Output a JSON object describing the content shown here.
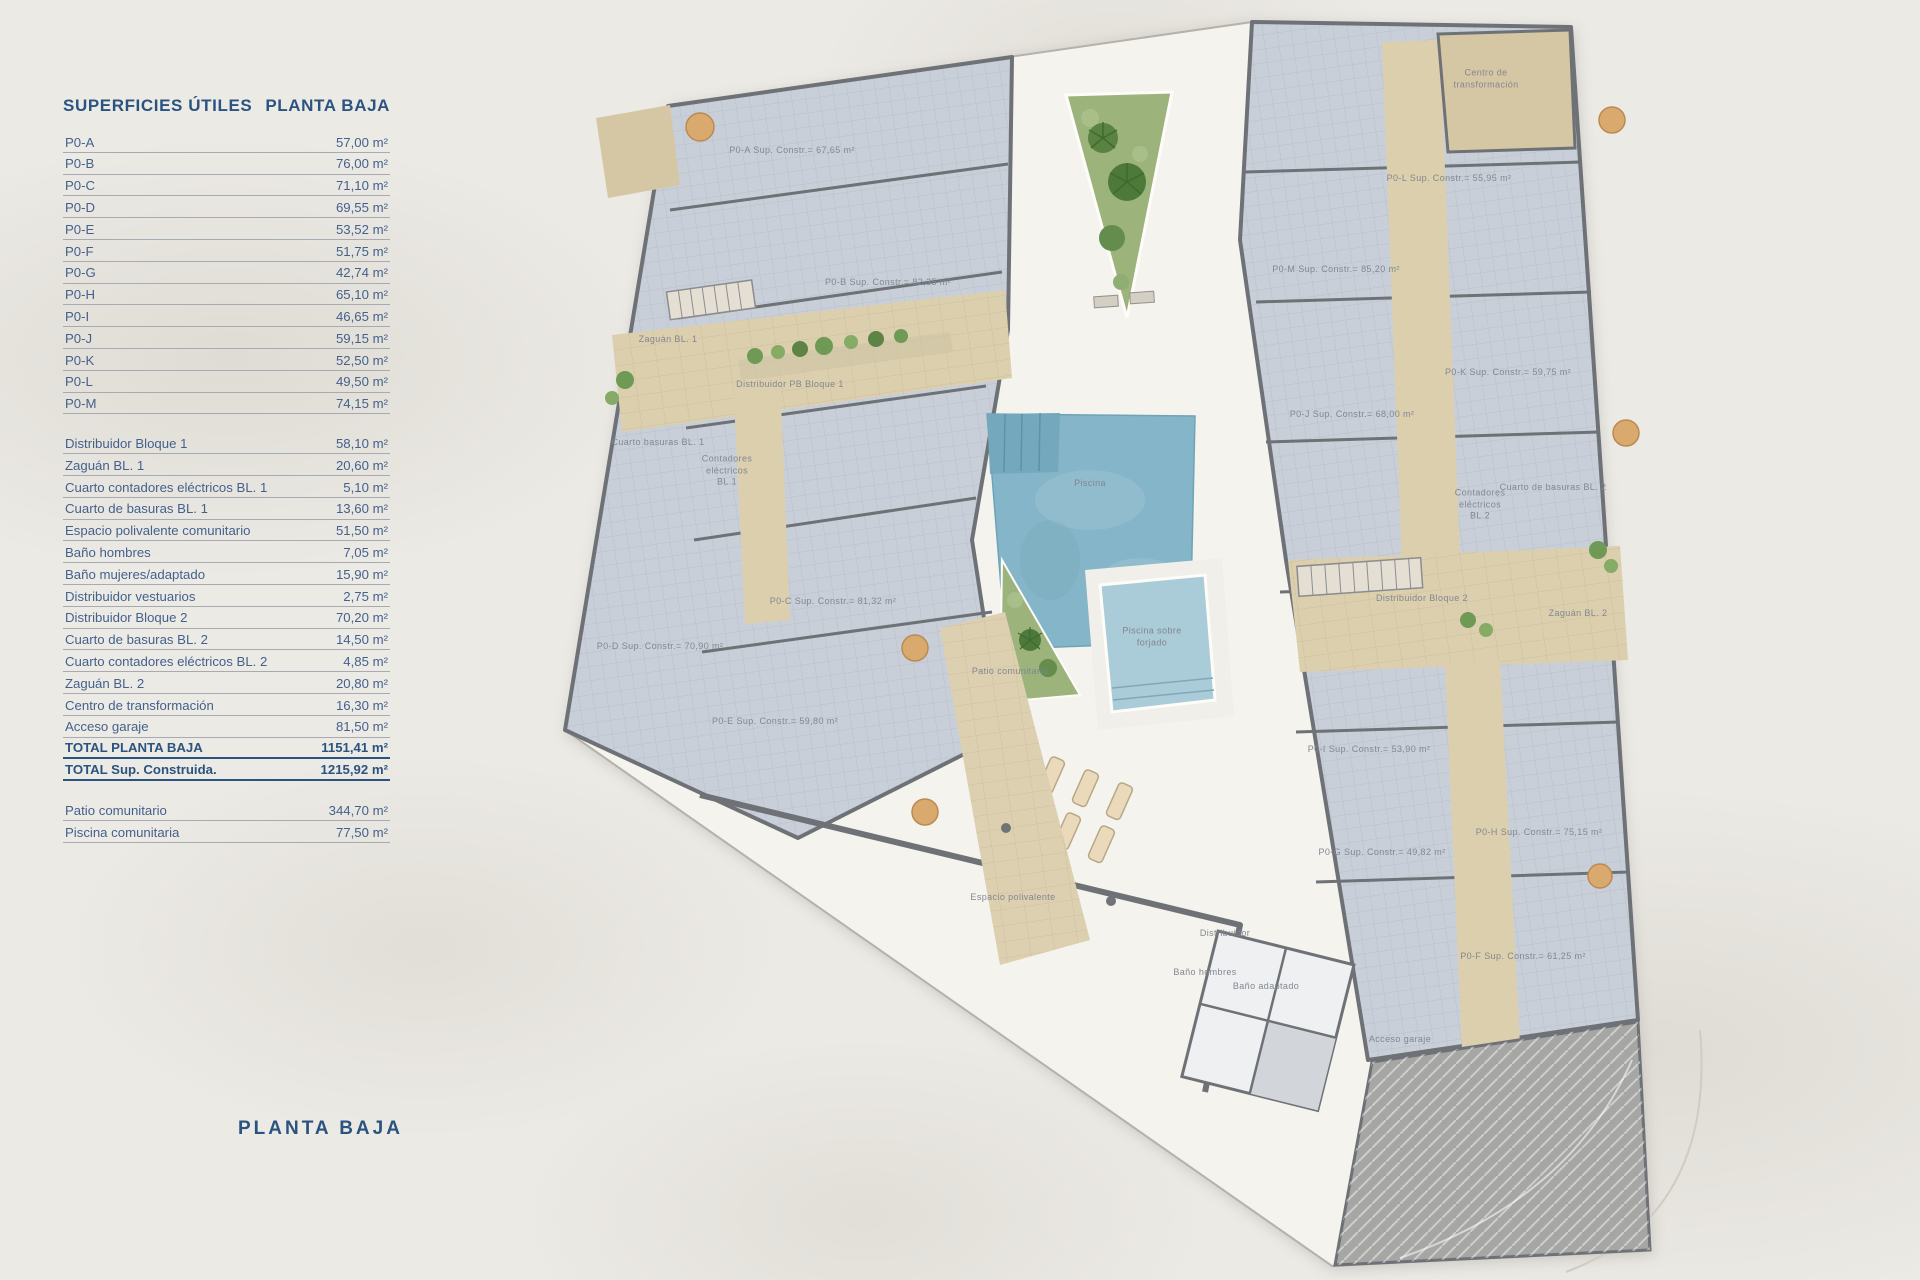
{
  "panel": {
    "title": "SUPERFICIES ÚTILES",
    "subtitle": "PLANTA BAJA",
    "unit_rows": [
      {
        "label": "P0-A",
        "value": "57,00 m²"
      },
      {
        "label": "P0-B",
        "value": "76,00 m²"
      },
      {
        "label": "P0-C",
        "value": "71,10 m²"
      },
      {
        "label": "P0-D",
        "value": "69,55 m²"
      },
      {
        "label": "P0-E",
        "value": "53,52 m²"
      },
      {
        "label": "P0-F",
        "value": "51,75 m²"
      },
      {
        "label": "P0-G",
        "value": "42,74 m²"
      },
      {
        "label": "P0-H",
        "value": "65,10 m²"
      },
      {
        "label": "P0-I",
        "value": "46,65 m²"
      },
      {
        "label": "P0-J",
        "value": "59,15 m²"
      },
      {
        "label": "P0-K",
        "value": "52,50 m²"
      },
      {
        "label": "P0-L",
        "value": "49,50 m²"
      },
      {
        "label": "P0-M",
        "value": "74,15 m²"
      }
    ],
    "common_rows": [
      {
        "label": "Distribuidor Bloque 1",
        "value": "58,10 m²"
      },
      {
        "label": "Zaguán BL. 1",
        "value": "20,60 m²"
      },
      {
        "label": "Cuarto contadores eléctricos BL. 1",
        "value": "5,10 m²"
      },
      {
        "label": "Cuarto de basuras BL. 1",
        "value": "13,60 m²"
      },
      {
        "label": "Espacio polivalente comunitario",
        "value": "51,50 m²"
      },
      {
        "label": "Baño hombres",
        "value": "7,05 m²"
      },
      {
        "label": "Baño mujeres/adaptado",
        "value": "15,90 m²"
      },
      {
        "label": "Distribuidor vestuarios",
        "value": "2,75 m²"
      },
      {
        "label": "Distribuidor Bloque 2",
        "value": "70,20 m²"
      },
      {
        "label": "Cuarto de basuras BL. 2",
        "value": "14,50 m²"
      },
      {
        "label": "Cuarto contadores eléctricos BL. 2",
        "value": "4,85 m²"
      },
      {
        "label": "Zaguán BL. 2",
        "value": "20,80 m²"
      },
      {
        "label": "Centro de transformación",
        "value": "16,30 m²"
      },
      {
        "label": "Acceso garaje",
        "value": "81,50 m²"
      }
    ],
    "total_rows": [
      {
        "label": "TOTAL PLANTA BAJA",
        "value": "1151,41 m²"
      },
      {
        "label": "TOTAL Sup. Construida.",
        "value": "1215,92 m²"
      }
    ],
    "extra_rows": [
      {
        "label": "Patio comunitario",
        "value": "344,70 m²"
      },
      {
        "label": "Piscina comunitaria",
        "value": "77,50 m²"
      }
    ],
    "footer_title": "PLANTA BAJA"
  },
  "plan": {
    "labels": [
      {
        "text": "P0-A Sup. Constr.= 67,65 m²",
        "x": 792,
        "y": 151
      },
      {
        "text": "P0-B Sup. Constr.= 82,35 m²",
        "x": 888,
        "y": 283
      },
      {
        "text": "Zaguán BL. 1",
        "x": 668,
        "y": 340
      },
      {
        "text": "Distribuidor PB Bloque 1",
        "x": 790,
        "y": 385
      },
      {
        "text": "Cuarto basuras BL. 1",
        "x": 658,
        "y": 443
      },
      {
        "text": "Contadores\neléctricos\nBL.1",
        "x": 727,
        "y": 471
      },
      {
        "text": "P0-C Sup. Constr.= 81,32 m²",
        "x": 833,
        "y": 602
      },
      {
        "text": "P0-D Sup. Constr.= 70,90 m²",
        "x": 660,
        "y": 647
      },
      {
        "text": "P0-E Sup. Constr.= 59,80 m²",
        "x": 775,
        "y": 722
      },
      {
        "text": "Piscina",
        "x": 1090,
        "y": 484
      },
      {
        "text": "Piscina sobre\nforjado",
        "x": 1152,
        "y": 637
      },
      {
        "text": "Patio comunitario",
        "x": 1010,
        "y": 672
      },
      {
        "text": "Espacio polivalente",
        "x": 1013,
        "y": 898
      },
      {
        "text": "Distribuidor",
        "x": 1225,
        "y": 934
      },
      {
        "text": "Baño hombres",
        "x": 1205,
        "y": 973
      },
      {
        "text": "Baño adaptado",
        "x": 1266,
        "y": 987
      },
      {
        "text": "Acceso garaje",
        "x": 1400,
        "y": 1040
      },
      {
        "text": "Centro de\ntransformación",
        "x": 1486,
        "y": 79
      },
      {
        "text": "P0-L Sup. Constr.= 55,95 m²",
        "x": 1449,
        "y": 179
      },
      {
        "text": "P0-M Sup. Constr.= 85,20 m²",
        "x": 1336,
        "y": 270
      },
      {
        "text": "P0-K Sup. Constr.= 59,75 m²",
        "x": 1508,
        "y": 373
      },
      {
        "text": "P0-J Sup. Constr.= 68,00 m²",
        "x": 1352,
        "y": 415
      },
      {
        "text": "Cuarto de basuras BL. 2",
        "x": 1553,
        "y": 488
      },
      {
        "text": "Contadores\neléctricos\nBL.2",
        "x": 1480,
        "y": 505
      },
      {
        "text": "Distribuidor Bloque 2",
        "x": 1422,
        "y": 599
      },
      {
        "text": "Zaguán BL. 2",
        "x": 1578,
        "y": 614
      },
      {
        "text": "P0-I Sup. Constr.= 53,90 m²",
        "x": 1369,
        "y": 750
      },
      {
        "text": "P0-G Sup. Constr.= 49,82 m²",
        "x": 1382,
        "y": 853
      },
      {
        "text": "P0-H Sup. Constr.= 75,15 m²",
        "x": 1539,
        "y": 833
      },
      {
        "text": "P0-F Sup. Constr.= 61,25 m²",
        "x": 1523,
        "y": 957
      }
    ]
  },
  "colors": {
    "accent_navy": "#2b5380",
    "table_blue": "#44618c",
    "wall_gray": "#6e7276",
    "room_fill": "#c9cfd9",
    "circulation_tan": "#dccfae",
    "pool_blue": "#84b5c8",
    "garden_green": "#9db37c",
    "paper": "#eceae5"
  }
}
